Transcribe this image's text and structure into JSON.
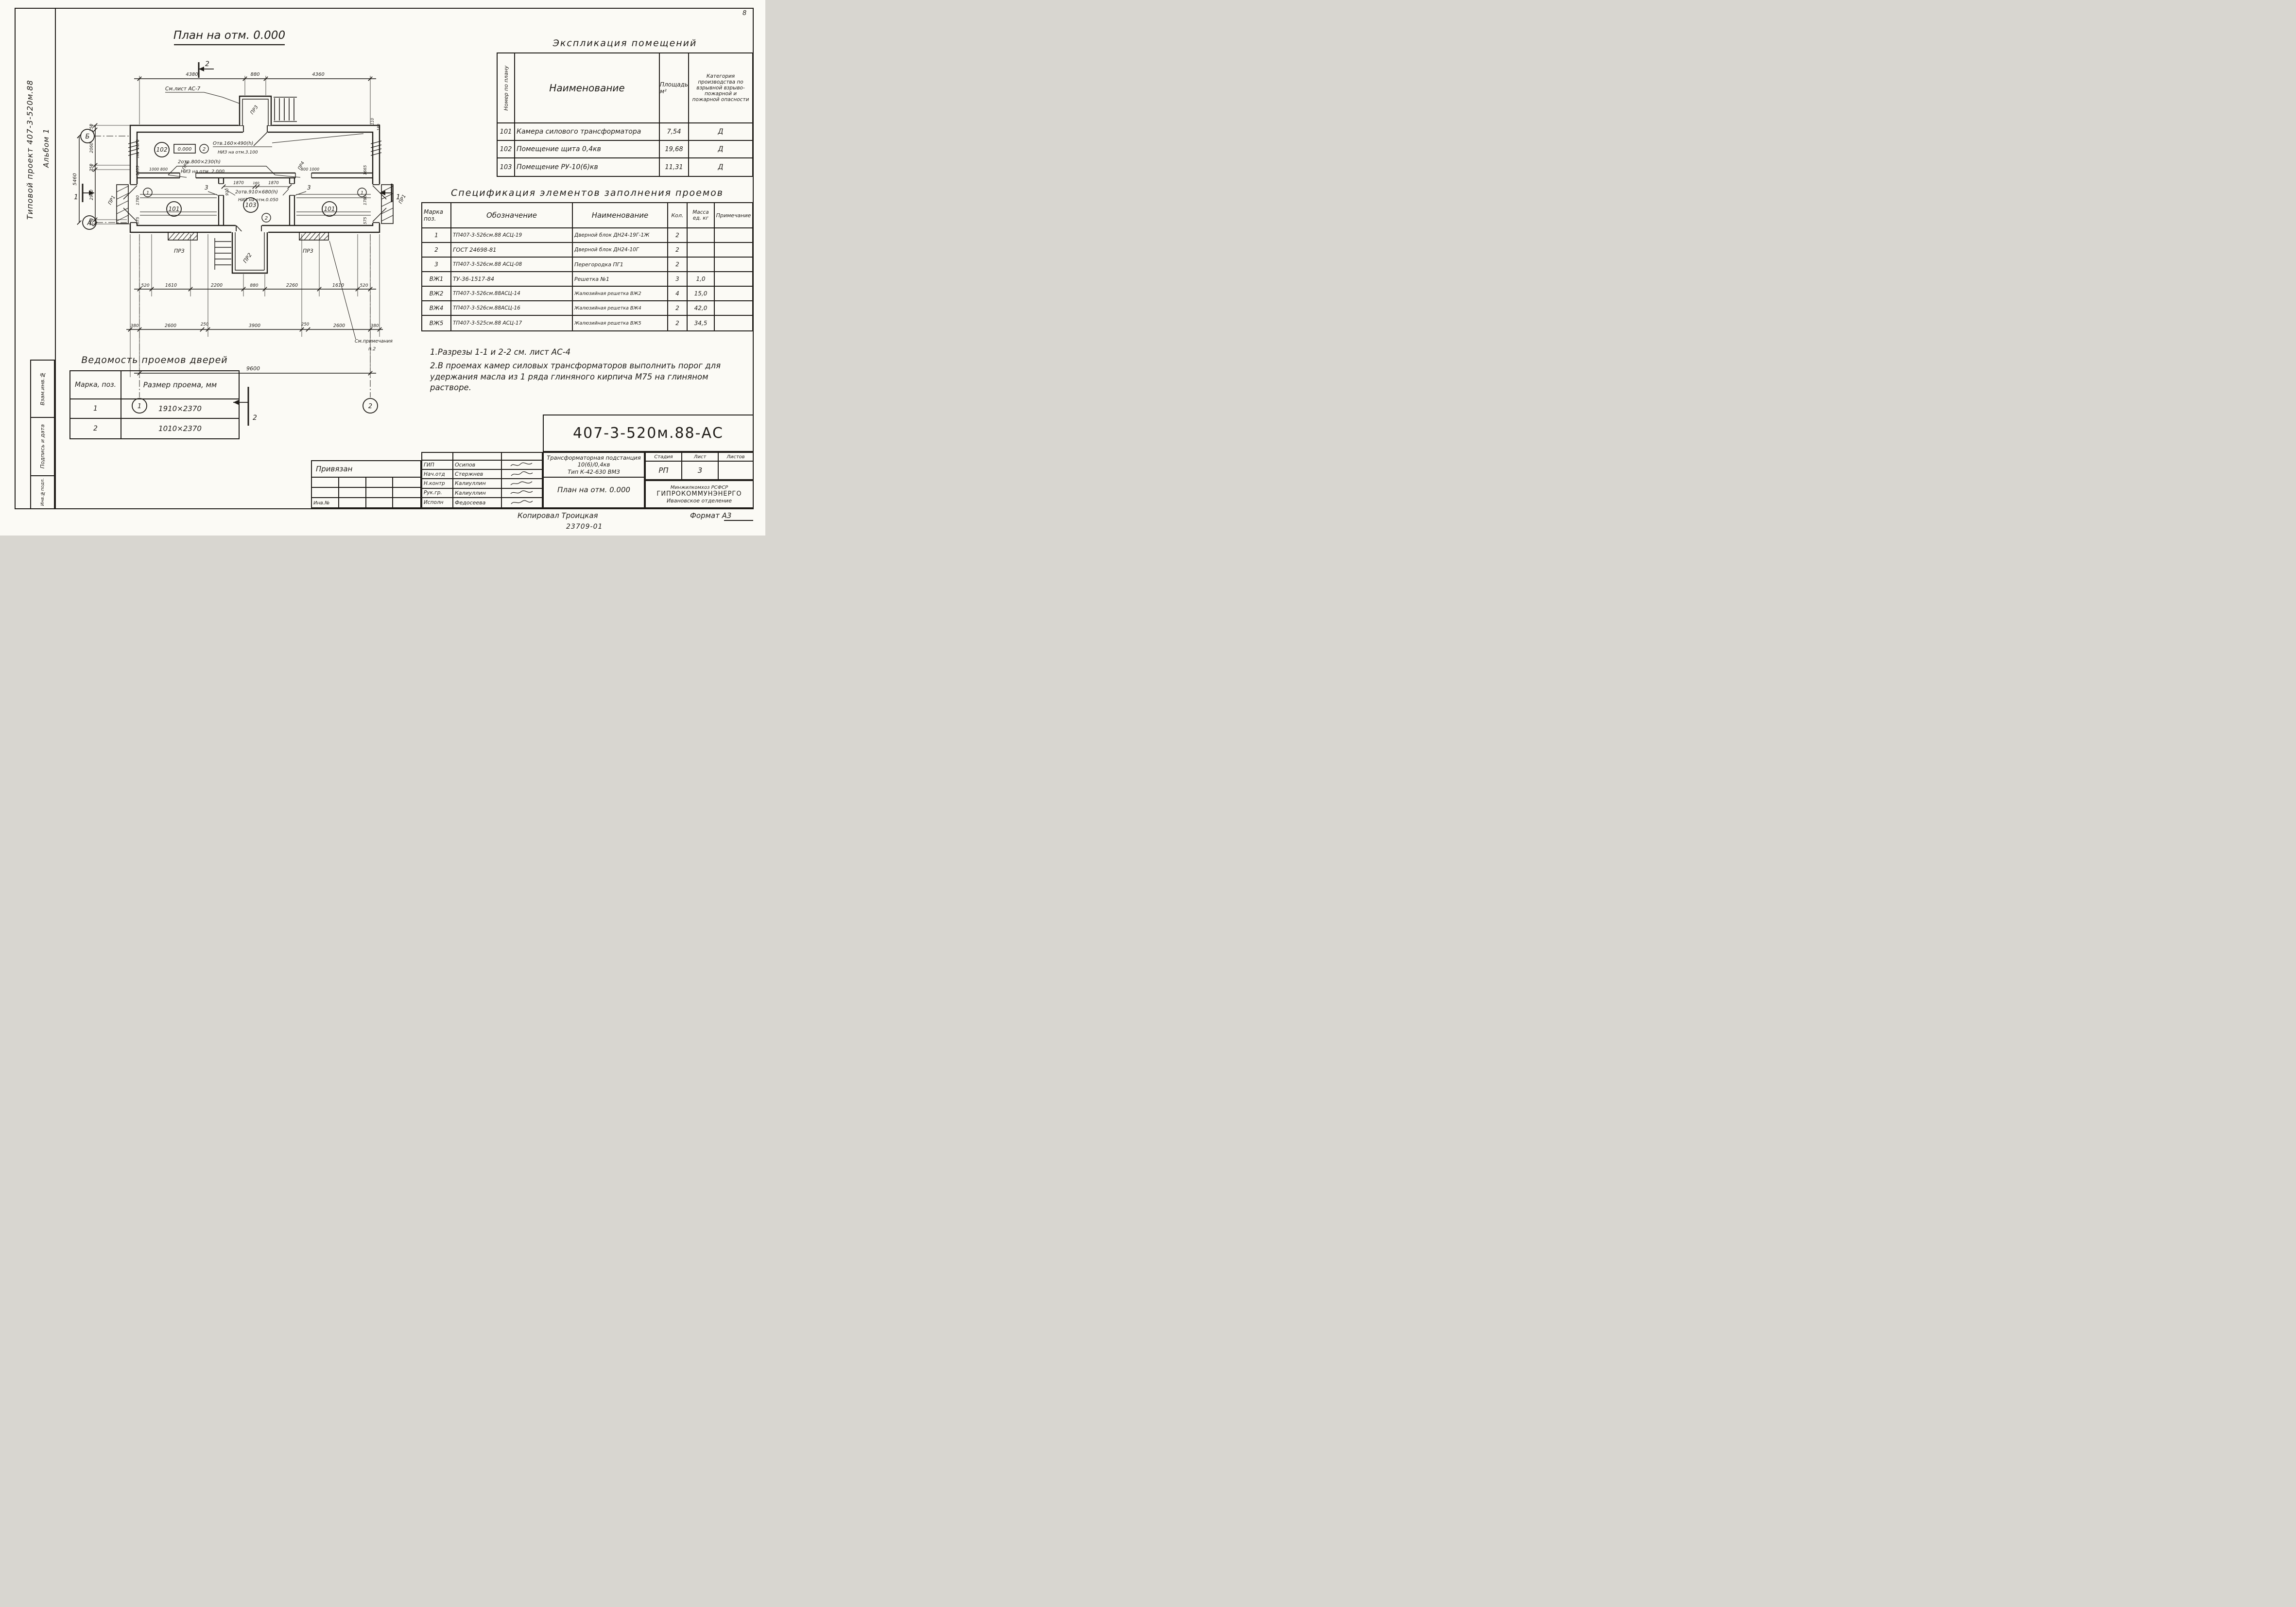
{
  "sheet": {
    "corner_mark": "8",
    "side": {
      "project": "Типовой проект 407-3-520м.88",
      "album": "Альбом 1",
      "boxes": [
        "Взам.инв.№",
        "Подпись и дата",
        "Инв.№подл."
      ]
    },
    "footer": {
      "copied_by": "Копировал Троицкая",
      "format": "Формат А3",
      "code": "23709-01"
    }
  },
  "plan": {
    "title": "План на отм. 0.000",
    "see_sheet": "См.лист АС-7",
    "see_note_1": "См.примечания",
    "see_note_2": "п.2",
    "axes": {
      "a": "А",
      "b": "Б",
      "n1": "1",
      "n2": "2"
    },
    "sections": {
      "s1": "1",
      "s2": "2"
    },
    "marks": {
      "m101": "101",
      "m102": "102",
      "m103": "103",
      "level": "0.000",
      "d1": "1",
      "d2": "2",
      "part3": "3"
    },
    "labels": {
      "pr1": "ПР1",
      "pr2": "ПР2",
      "pr3": "ПР3",
      "pr4": "ПР4"
    },
    "ann": {
      "a1a": "Отв.160×490(h)",
      "a1b": "НИЗ на отм.3.100",
      "a2a": "2отв.800×230(h)",
      "a2b": "НИЗ на отм. 2.000",
      "a3a": "2отв.910×680(h)",
      "a3b": "НИЗ на отм.0.050"
    },
    "dims": {
      "top": [
        "4380",
        "880",
        "4360"
      ],
      "bottom1": [
        "520",
        "1610",
        "2200",
        "880",
        "2260",
        "1610",
        "520"
      ],
      "bottom2": [
        "380",
        "2600",
        "250",
        "3900",
        "250",
        "2600",
        "380"
      ],
      "total": "9600",
      "left_outer": "5460",
      "left_chain": [
        "250",
        "2060",
        "250",
        "2900",
        "250"
      ],
      "left_inner": [
        "1070",
        "160",
        "1655",
        "1780",
        "575"
      ],
      "right_inner": [
        "1665",
        "1780",
        "575"
      ],
      "right_top": [
        "110",
        "180"
      ],
      "interior": [
        "1870",
        "160",
        "1870"
      ],
      "door_width": "910",
      "vent_left": "1000  800",
      "vent_right": "800  1000"
    }
  },
  "explication": {
    "title": "Экспликация помещений",
    "headers": [
      "Номер по плану",
      "Наименование",
      "Площадь м²",
      "Категория производства по взрывной взрыво-пожарной и пожарной опасности"
    ],
    "rows": [
      [
        "101",
        "Камера силового трансформатора",
        "7,54",
        "Д"
      ],
      [
        "102",
        "Помещение щита 0,4кв",
        "19,68",
        "Д"
      ],
      [
        "103",
        "Помещение РУ-10(6)кв",
        "11,31",
        "Д"
      ]
    ]
  },
  "spec": {
    "title": "Спецификация элементов заполнения проемов",
    "headers": [
      "Марка поз.",
      "Обозначение",
      "Наименование",
      "Кол.",
      "Масса ед. кг",
      "Примечание"
    ],
    "rows": [
      [
        "1",
        "ТП407-3-526см.88 АСЦ-19",
        "Дверной блок ДН24-19Г-1Ж",
        "2",
        "",
        ""
      ],
      [
        "2",
        "ГОСТ 24698-81",
        "Дверной блок ДН24-10Г",
        "2",
        "",
        ""
      ],
      [
        "3",
        "ТП407-3-526см.88 АСЦ-08",
        "Перегородка ПГ1",
        "2",
        "",
        ""
      ],
      [
        "ВЖ1",
        "ТУ-36-1517-84",
        "Решетка №1",
        "3",
        "1,0",
        ""
      ],
      [
        "ВЖ2",
        "ТП407-3-526см.88АСЦ-14",
        "Жалюзийная решетка  ВЖ2",
        "4",
        "15,0",
        ""
      ],
      [
        "ВЖ4",
        "ТП407-3-526см.88АСЦ-16",
        "Жалюзийная решетка  ВЖ4",
        "2",
        "42,0",
        ""
      ],
      [
        "ВЖ5",
        "ТП407-3-525см.88 АСЦ-17",
        "Жалюзийная решетка  ВЖ5",
        "2",
        "34,5",
        ""
      ]
    ]
  },
  "notes": [
    "1.Разрезы 1-1 и 2-2 см. лист АС-4",
    "2.В проемах камер силовых трансформаторов выполнить порог для удержания масла из 1 ряда глиняного кирпича М75 на глиняном растворе."
  ],
  "doors": {
    "title": "Ведомость проемов дверей",
    "headers": [
      "Марка, поз.",
      "Размер проема, мм"
    ],
    "rows": [
      [
        "1",
        "1910×2370"
      ],
      [
        "2",
        "1010×2370"
      ]
    ]
  },
  "stamp": {
    "code": "407-3-520м.88-АС",
    "attach": "Привязан",
    "inv": "Инв.№",
    "sign_rows": [
      [
        "ГИП",
        "Осипов"
      ],
      [
        "Нач.отд",
        "Стержнев"
      ],
      [
        "Н.контр",
        "Калиуллин"
      ],
      [
        "Рук.гр.",
        "Калиуллин"
      ],
      [
        "Исполн",
        "Федосеева"
      ]
    ],
    "object_lines": [
      "Трансформаторная подстанция",
      "10(6)/0,4кв",
      "Тип К-42-630 ВМЗ"
    ],
    "sheet_name": "План на отм. 0.000",
    "stage_headers": [
      "Стадия",
      "Лист",
      "Листов"
    ],
    "stage": "РП",
    "list": "3",
    "total": "",
    "org": [
      "Минжилкомхоз РСФСР",
      "ГИПРОКОММУНЭНЕРГО",
      "Ивановское отделение"
    ]
  }
}
